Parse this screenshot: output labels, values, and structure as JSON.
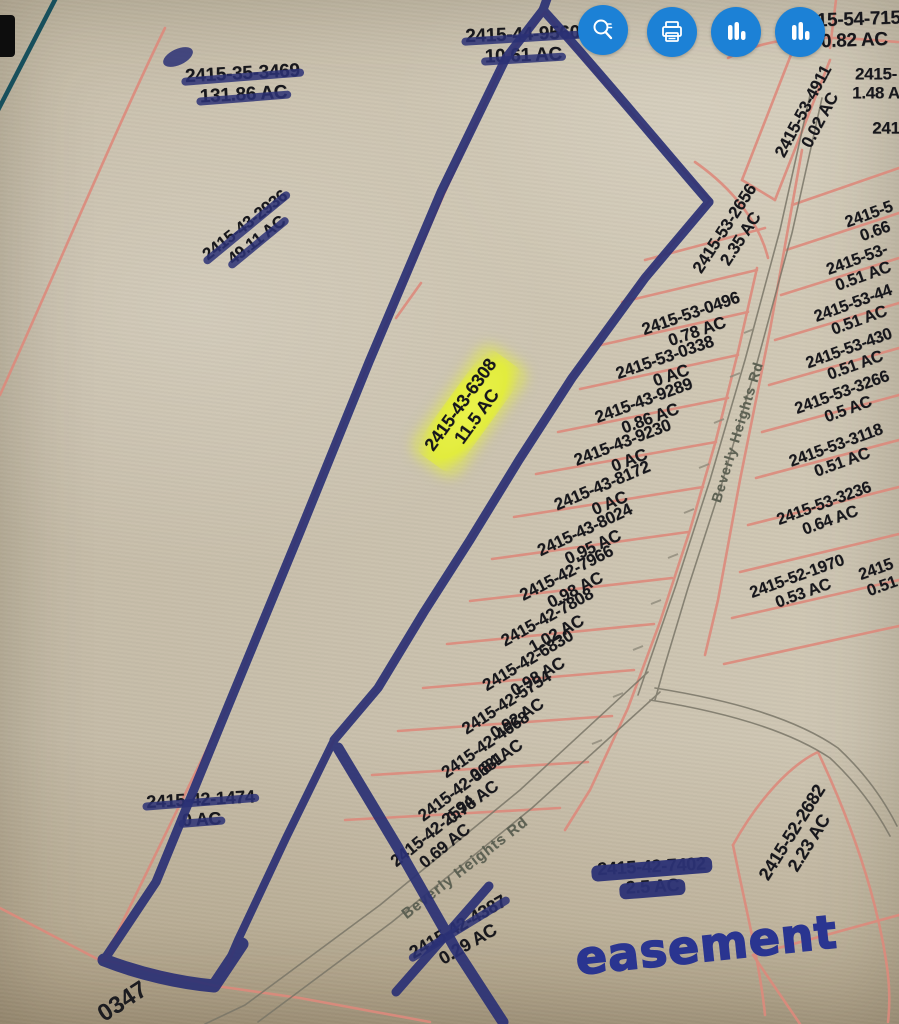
{
  "app": {
    "type": "parcel-map-viewer"
  },
  "toolbar": {
    "button_color": "#1c81d6",
    "buttons": [
      {
        "name": "search",
        "icon": "magnifier-icon"
      },
      {
        "name": "print",
        "icon": "printer-icon"
      },
      {
        "name": "chart-a",
        "icon": "bar-chart-icon"
      },
      {
        "name": "chart-b",
        "icon": "bar-chart-icon"
      }
    ]
  },
  "map": {
    "paper_color": "#d8d1bf",
    "parcel_line_color": "#dd8a7c",
    "marker_color": "#2b3175",
    "highlight_color": "#e4ee3f",
    "road_labels": [
      {
        "text": "Beverly Heights Rd"
      },
      {
        "text": "Beverly Heights Rd"
      }
    ],
    "annotations": {
      "easement": "easement"
    },
    "corner_label": "0347",
    "parcels": [
      {
        "id": "2415-35-3469",
        "ac": "131.86 AC",
        "struck": [
          true,
          true
        ]
      },
      {
        "id": "2415-44-9560",
        "ac": "10.61 AC",
        "struck": [
          true,
          true
        ]
      },
      {
        "id": "2415-54-7150",
        "ac": "0.82 AC",
        "struck": [
          false,
          false
        ]
      },
      {
        "id": "2415-53-4911",
        "ac": "0.02 AC",
        "struck": [
          false,
          false
        ]
      },
      {
        "id": "2415-",
        "ac": "1.48 A",
        "struck": [
          false,
          false
        ]
      },
      {
        "id": "241",
        "ac": "",
        "struck": [
          false,
          false
        ]
      },
      {
        "id": "2415-53-2656",
        "ac": "2.35 AC",
        "struck": [
          false,
          false
        ]
      },
      {
        "id": "2415-43-2936",
        "ac": "49.11 AC",
        "struck": [
          true,
          true
        ]
      },
      {
        "id": "2415-53-0496",
        "ac": "0.78 AC",
        "struck": [
          false,
          false
        ]
      },
      {
        "id": "2415-53-0338",
        "ac": "0 AC",
        "struck": [
          false,
          false
        ]
      },
      {
        "id": "2415-43-9289",
        "ac": "0.86 AC",
        "struck": [
          false,
          false
        ]
      },
      {
        "id": "2415-43-9230",
        "ac": "0 AC",
        "struck": [
          false,
          false
        ]
      },
      {
        "id": "2415-43-8172",
        "ac": "0 AC",
        "struck": [
          false,
          false
        ]
      },
      {
        "id": "2415-43-8024",
        "ac": "0.95 AC",
        "struck": [
          false,
          false
        ]
      },
      {
        "id": "2415-42-7966",
        "ac": "0.98 AC",
        "struck": [
          false,
          false
        ]
      },
      {
        "id": "2415-42-7808",
        "ac": "1.02 AC",
        "struck": [
          false,
          false
        ]
      },
      {
        "id": "2415-42-6830",
        "ac": "0.98 AC",
        "struck": [
          false,
          false
        ]
      },
      {
        "id": "2415-42-5754",
        "ac": "0.92 AC",
        "struck": [
          false,
          false
        ]
      },
      {
        "id": "2415-42-4668",
        "ac": "0.84 AC",
        "struck": [
          false,
          false
        ]
      },
      {
        "id": "2415-42-3681",
        "ac": "0.78 AC",
        "struck": [
          false,
          false
        ]
      },
      {
        "id": "2415-42-2594",
        "ac": "0.69 AC",
        "struck": [
          false,
          false
        ]
      },
      {
        "id": "2415-43-6308",
        "ac": "11.5 AC",
        "struck": [
          false,
          false
        ],
        "highlighted": true
      },
      {
        "id": "2415-5",
        "ac": "0.66",
        "struck": [
          false,
          false
        ]
      },
      {
        "id": "2415-53-",
        "ac": "0.51 AC",
        "struck": [
          false,
          false
        ]
      },
      {
        "id": "2415-53-44",
        "ac": "0.51 AC",
        "struck": [
          false,
          false
        ]
      },
      {
        "id": "2415-53-430",
        "ac": "0.51 AC",
        "struck": [
          false,
          false
        ]
      },
      {
        "id": "2415-53-3266",
        "ac": "0.5 AC",
        "struck": [
          false,
          false
        ]
      },
      {
        "id": "2415-53-3118",
        "ac": "0.51 AC",
        "struck": [
          false,
          false
        ]
      },
      {
        "id": "2415-53-3236",
        "ac": "0.64 AC",
        "struck": [
          false,
          false
        ]
      },
      {
        "id": "2415-52-1970",
        "ac": "0.53 AC",
        "struck": [
          false,
          false
        ]
      },
      {
        "id": "2415",
        "ac": "0.51",
        "struck": [
          false,
          false
        ]
      },
      {
        "id": "2415-52-2682",
        "ac": "2.23 AC",
        "struck": [
          false,
          false
        ]
      },
      {
        "id": "2415-42-1474",
        "ac": "0 AC",
        "struck": [
          true,
          true
        ]
      },
      {
        "id": "2415-42-7402",
        "ac": "2.5 AC",
        "struck": [
          true,
          true
        ],
        "heavy": true
      },
      {
        "id": "2415-42-4387",
        "ac": "0.29 AC",
        "struck": [
          true,
          false
        ],
        "xmark": true
      }
    ]
  }
}
